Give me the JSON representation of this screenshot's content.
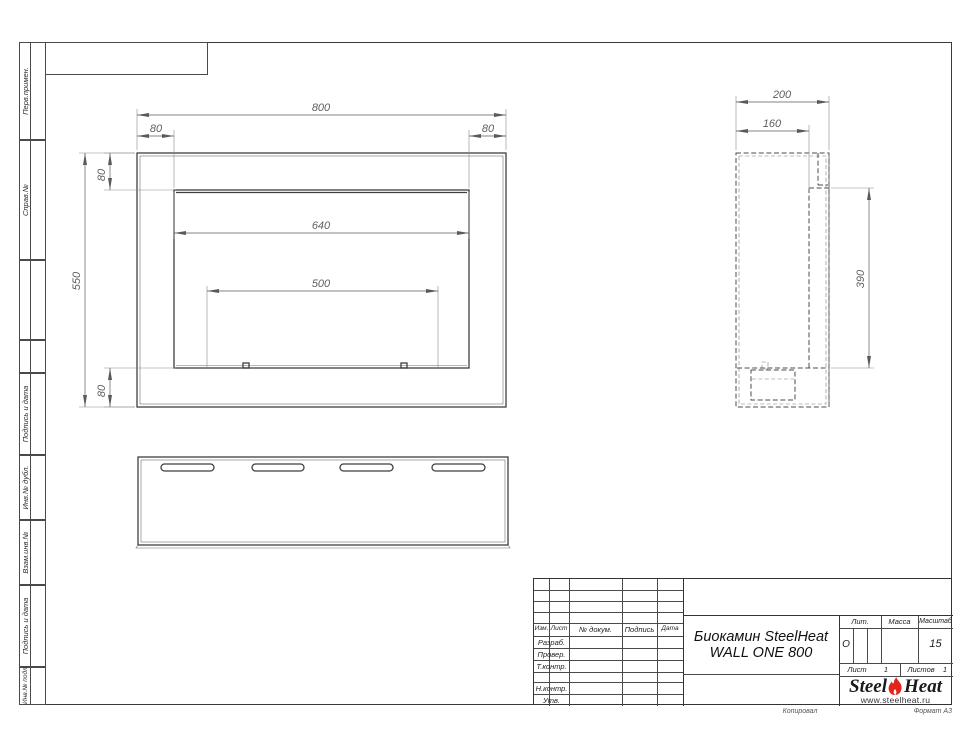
{
  "sidebar": {
    "top": [
      {
        "label": "Перв.примен."
      },
      {
        "label": "Справ.№"
      }
    ],
    "bottom": [
      {
        "label": "Подпись и дата"
      },
      {
        "label": "Инв.№ дубл."
      },
      {
        "label": "Взам.инв.№"
      },
      {
        "label": "Подпись и дата"
      },
      {
        "label": "Инв.№ подл."
      }
    ]
  },
  "views": {
    "front": {
      "dim_width": "800",
      "dim_top_left": "80",
      "dim_top_right": "80",
      "dim_side_top": "80",
      "dim_height": "550",
      "dim_opening": "640",
      "dim_inner": "500",
      "dim_side_bottom": "80"
    },
    "side": {
      "dim_depth": "200",
      "dim_depth_inner": "160",
      "dim_height_inner": "390"
    }
  },
  "title_block": {
    "header_cols": [
      "Изм.",
      "Лист",
      "№ докум.",
      "Подпись",
      "Дата"
    ],
    "role_rows": [
      "Разраб.",
      "Провер.",
      "Т.контр.",
      "Н.контр.",
      "Утв."
    ],
    "title_line1": "Биокамин SteelHeat",
    "title_line2": "WALL ONE 800",
    "lit_label": "Лит.",
    "lit_value": "О",
    "mass_label": "Масса",
    "scale_label": "Масштаб",
    "scale_value": "15",
    "sheet_label": "Лист",
    "sheet_value": "1",
    "sheets_label": "Листов",
    "sheets_value": "1",
    "logo_steel": "Steel",
    "logo_heat": "Heat",
    "logo_url": "www.steelheat.ru",
    "footer_copy": "Копировал",
    "footer_format": "Формат А3"
  },
  "colors": {
    "flame_red": "#e3241d",
    "line": "#3f3f3f"
  }
}
